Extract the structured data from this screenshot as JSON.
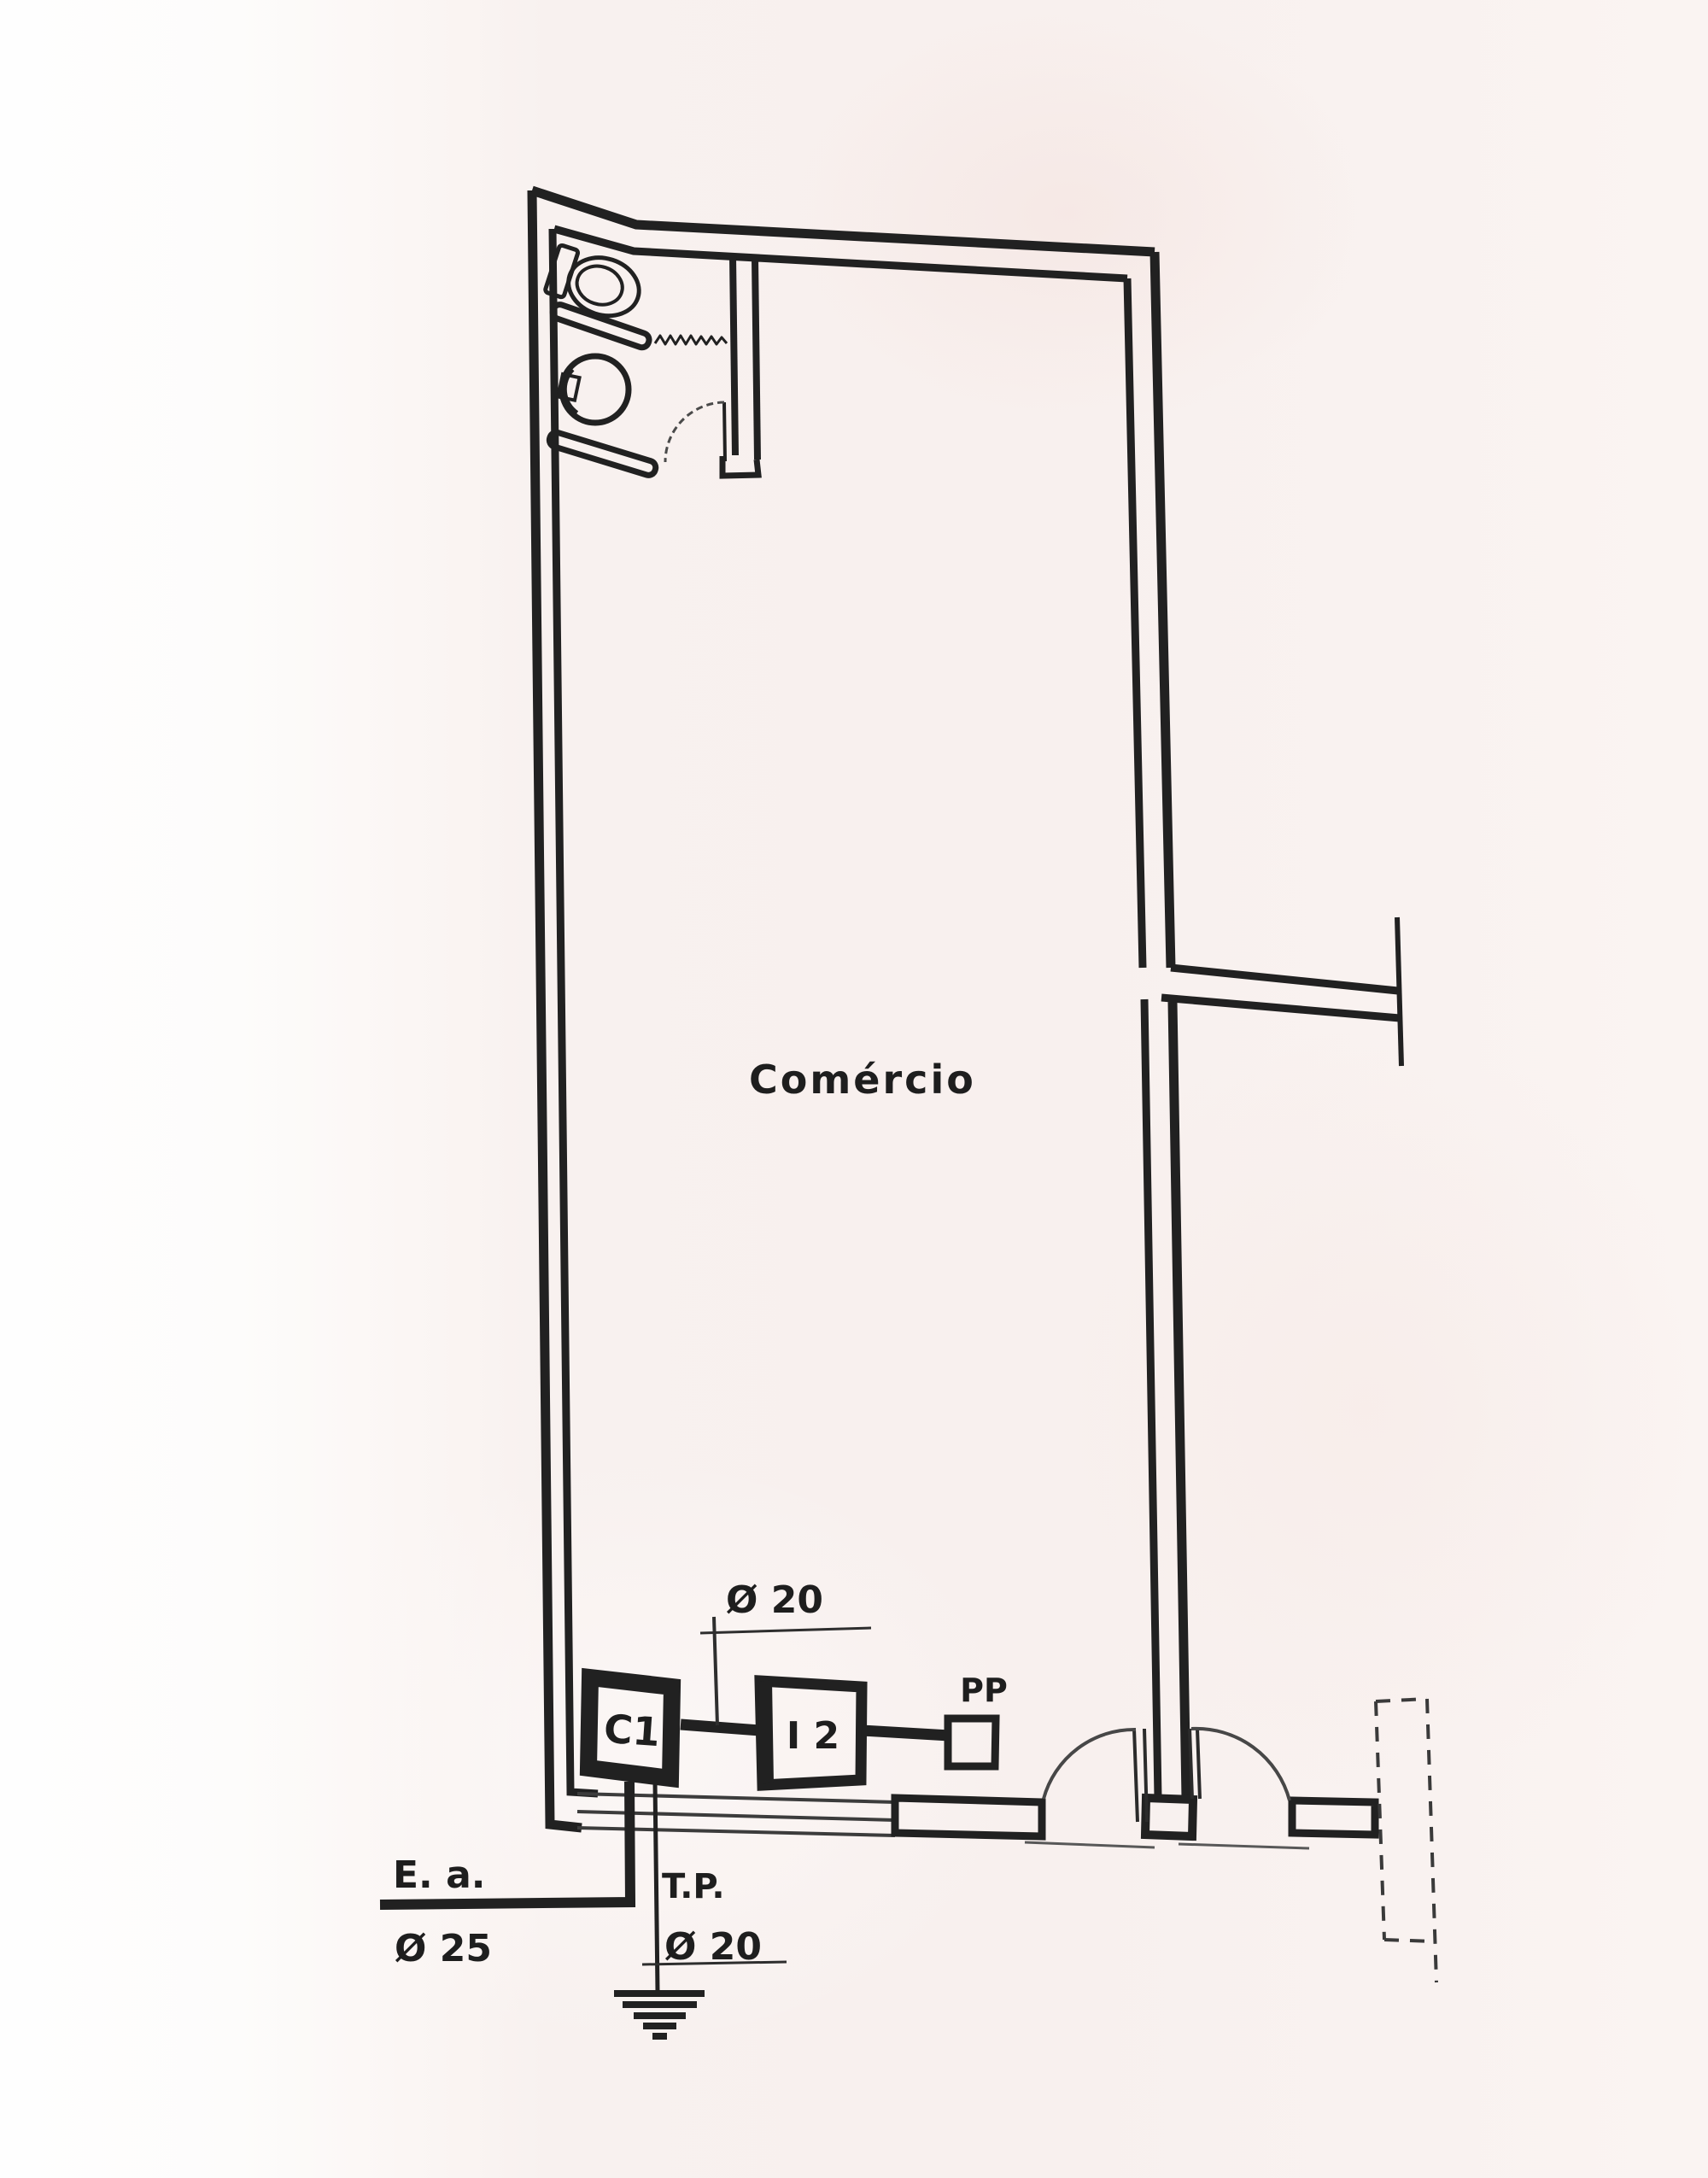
{
  "plan": {
    "room_label": "Comércio",
    "boxes": {
      "c1": "C1",
      "i2": "I 2",
      "pp": "PP"
    },
    "annotations": {
      "dim_conduit_top": "Ø 20",
      "ea_label": "E. a.",
      "ea_dim": "Ø 25",
      "tp_label": "T.P.",
      "tp_dim": "Ø 20"
    },
    "colors": {
      "ink": "#212121",
      "ink_soft": "#474747",
      "paper": "#f8f1ef",
      "paper_light": "#fdfdfd"
    }
  }
}
